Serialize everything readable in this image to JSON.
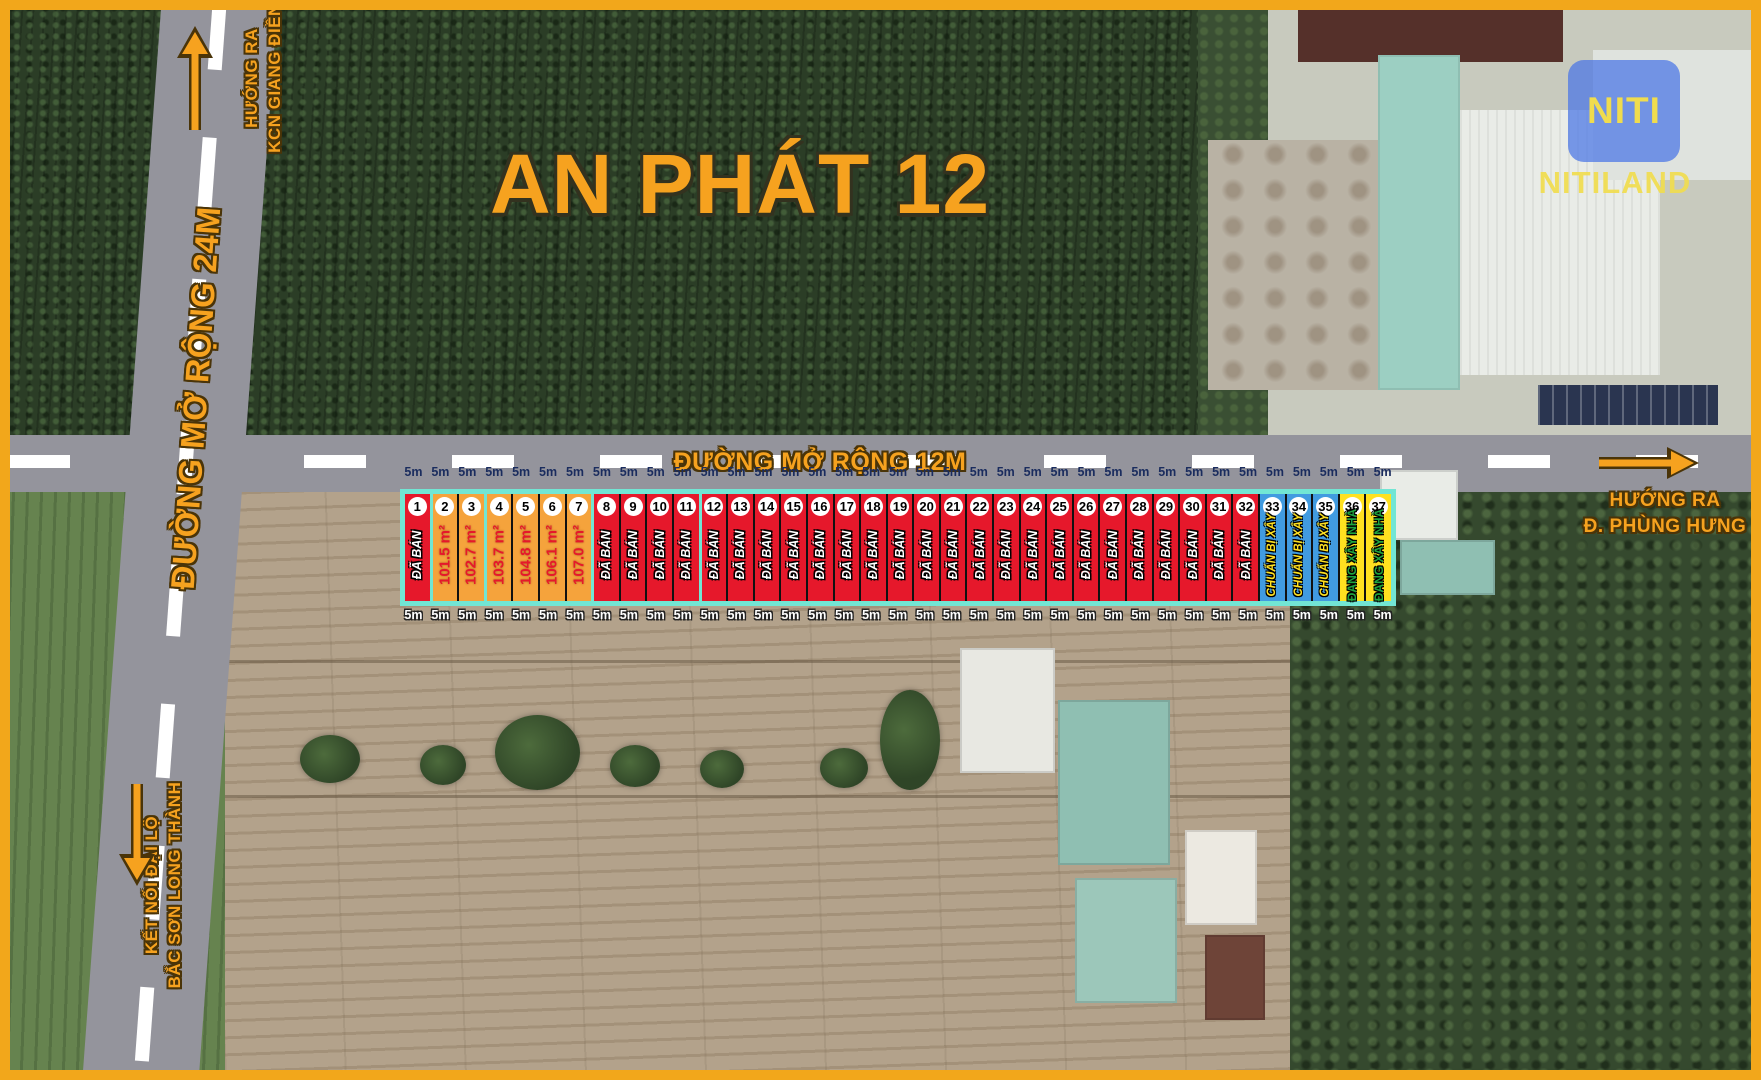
{
  "title": "AN PHÁT 12",
  "brand": {
    "logo_text": "NITI",
    "brand_name": "NITILAND"
  },
  "roads": {
    "vertical_label": "ĐƯỜNG MỞ RỘNG 24M",
    "horizontal_label": "ĐƯỜNG MỞ RỘNG 12M"
  },
  "directions": {
    "top_left_line1": "HƯỚNG RA",
    "top_left_line2": "KCN GIANG ĐIỀN",
    "right_line1": "HƯỚNG RA",
    "right_line2": "Đ. PHÙNG HƯNG",
    "bottom_left_line1": "KẾT NỐI ĐẠI LỘ",
    "bottom_left_line2": "BẮC SƠN LONG THÀNH"
  },
  "plot_strip": {
    "frontage_label": "5m",
    "divider_after_plots": [
      1,
      3,
      7,
      11
    ],
    "statuses": {
      "sold": {
        "label": "ĐÃ BÁN",
        "bg": "#E6182B",
        "fg": "#FFFFFF"
      },
      "available": {
        "label": "",
        "bg": "#F5A33C",
        "fg": "#E6182B"
      },
      "preparing": {
        "label": "CHUẨN BỊ XÂY",
        "bg": "#419BE0",
        "fg": "#FFE120"
      },
      "building": {
        "label": "ĐANG XÂY NHÀ",
        "bg": "#FFE120",
        "fg": "#1FA440"
      }
    },
    "plots": [
      {
        "number": 1,
        "status": "sold"
      },
      {
        "number": 2,
        "status": "available",
        "area": "101.5 m²"
      },
      {
        "number": 3,
        "status": "available",
        "area": "102.7 m²"
      },
      {
        "number": 4,
        "status": "available",
        "area": "103.7 m²"
      },
      {
        "number": 5,
        "status": "available",
        "area": "104.8 m²"
      },
      {
        "number": 6,
        "status": "available",
        "area": "106.1 m²"
      },
      {
        "number": 7,
        "status": "available",
        "area": "107.0 m²"
      },
      {
        "number": 8,
        "status": "sold"
      },
      {
        "number": 9,
        "status": "sold"
      },
      {
        "number": 10,
        "status": "sold"
      },
      {
        "number": 11,
        "status": "sold"
      },
      {
        "number": 12,
        "status": "sold"
      },
      {
        "number": 13,
        "status": "sold"
      },
      {
        "number": 14,
        "status": "sold"
      },
      {
        "number": 15,
        "status": "sold"
      },
      {
        "number": 16,
        "status": "sold"
      },
      {
        "number": 17,
        "status": "sold"
      },
      {
        "number": 18,
        "status": "sold"
      },
      {
        "number": 19,
        "status": "sold"
      },
      {
        "number": 20,
        "status": "sold"
      },
      {
        "number": 21,
        "status": "sold"
      },
      {
        "number": 22,
        "status": "sold"
      },
      {
        "number": 23,
        "status": "sold"
      },
      {
        "number": 24,
        "status": "sold"
      },
      {
        "number": 25,
        "status": "sold"
      },
      {
        "number": 26,
        "status": "sold"
      },
      {
        "number": 27,
        "status": "sold"
      },
      {
        "number": 28,
        "status": "sold"
      },
      {
        "number": 29,
        "status": "sold"
      },
      {
        "number": 30,
        "status": "sold"
      },
      {
        "number": 31,
        "status": "sold"
      },
      {
        "number": 32,
        "status": "sold"
      },
      {
        "number": 33,
        "status": "preparing"
      },
      {
        "number": 34,
        "status": "preparing"
      },
      {
        "number": 35,
        "status": "preparing"
      },
      {
        "number": 36,
        "status": "building"
      },
      {
        "number": 37,
        "status": "building"
      }
    ]
  },
  "colors": {
    "accent_orange": "#F6A21F",
    "road_gray": "#94949C",
    "strip_border_teal": "#72E6D4",
    "frontage_top_navy": "#1A2C5E",
    "logo_blue": "#4874E6",
    "logo_yellow": "#F0DC4E"
  }
}
